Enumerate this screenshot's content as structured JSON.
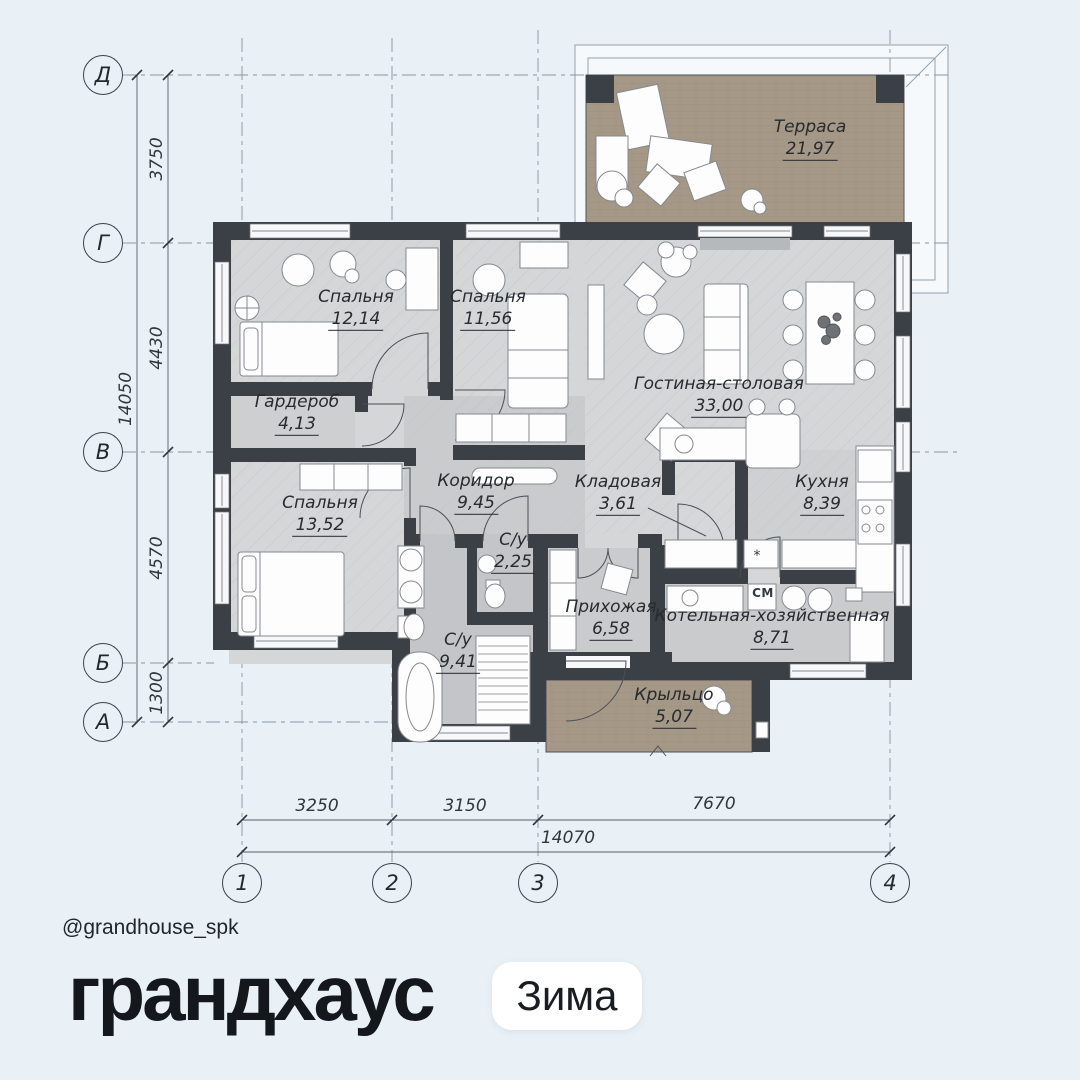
{
  "theme": {
    "bg": "#e9f1f7",
    "wall": "#3b4046",
    "floor": "#d4d6d8",
    "floor-mid": "#c9cbcd",
    "floor-dark": "#c3c5c8",
    "floor-light": "#d6d7d9",
    "kitchen": "#ced0d2",
    "terrace": "#a59887",
    "window": "#f7f8f9",
    "line": "#555f68",
    "grid": "#8795a1",
    "ink": "#262b30",
    "brand": "#14171b",
    "badge-bg": "#ffffff",
    "roof": "#f6f9fb",
    "furn": "#85898e"
  },
  "branding": {
    "handle": "@grandhouse_spk",
    "logo": "грандхаус",
    "badge": "Зима"
  },
  "plan": {
    "rooms": [
      {
        "name": "Терраса",
        "area": "21,97"
      },
      {
        "name": "Спальня",
        "area": "12,14"
      },
      {
        "name": "Спальня",
        "area": "11,56"
      },
      {
        "name": "Гостиная-столовая",
        "area": "33,00"
      },
      {
        "name": "Гардероб",
        "area": "4,13"
      },
      {
        "name": "Спальня",
        "area": "13,52"
      },
      {
        "name": "Коридор",
        "area": "9,45"
      },
      {
        "name": "Кладовая",
        "area": "3,61"
      },
      {
        "name": "Кухня",
        "area": "8,39"
      },
      {
        "name": "С/у",
        "area": "2,25"
      },
      {
        "name": "С/у",
        "area": "9,41"
      },
      {
        "name": "Прихожая",
        "area": "6,58"
      },
      {
        "name": "Котельная-хозяйственная",
        "area": "8,71"
      },
      {
        "name": "Крыльцо",
        "area": "5,07"
      }
    ],
    "labels": {
      "washing_machine": "СМ",
      "hob": "*"
    },
    "axes_rows": [
      "Д",
      "Г",
      "В",
      "Б",
      "А"
    ],
    "axes_cols": [
      "1",
      "2",
      "3",
      "4"
    ],
    "dims_left": [
      "3750",
      "4430",
      "4570",
      "1300"
    ],
    "dims_left_total": "14050",
    "dims_bottom": [
      "3250",
      "3150",
      "7670"
    ],
    "dims_bottom_total": "14070"
  }
}
